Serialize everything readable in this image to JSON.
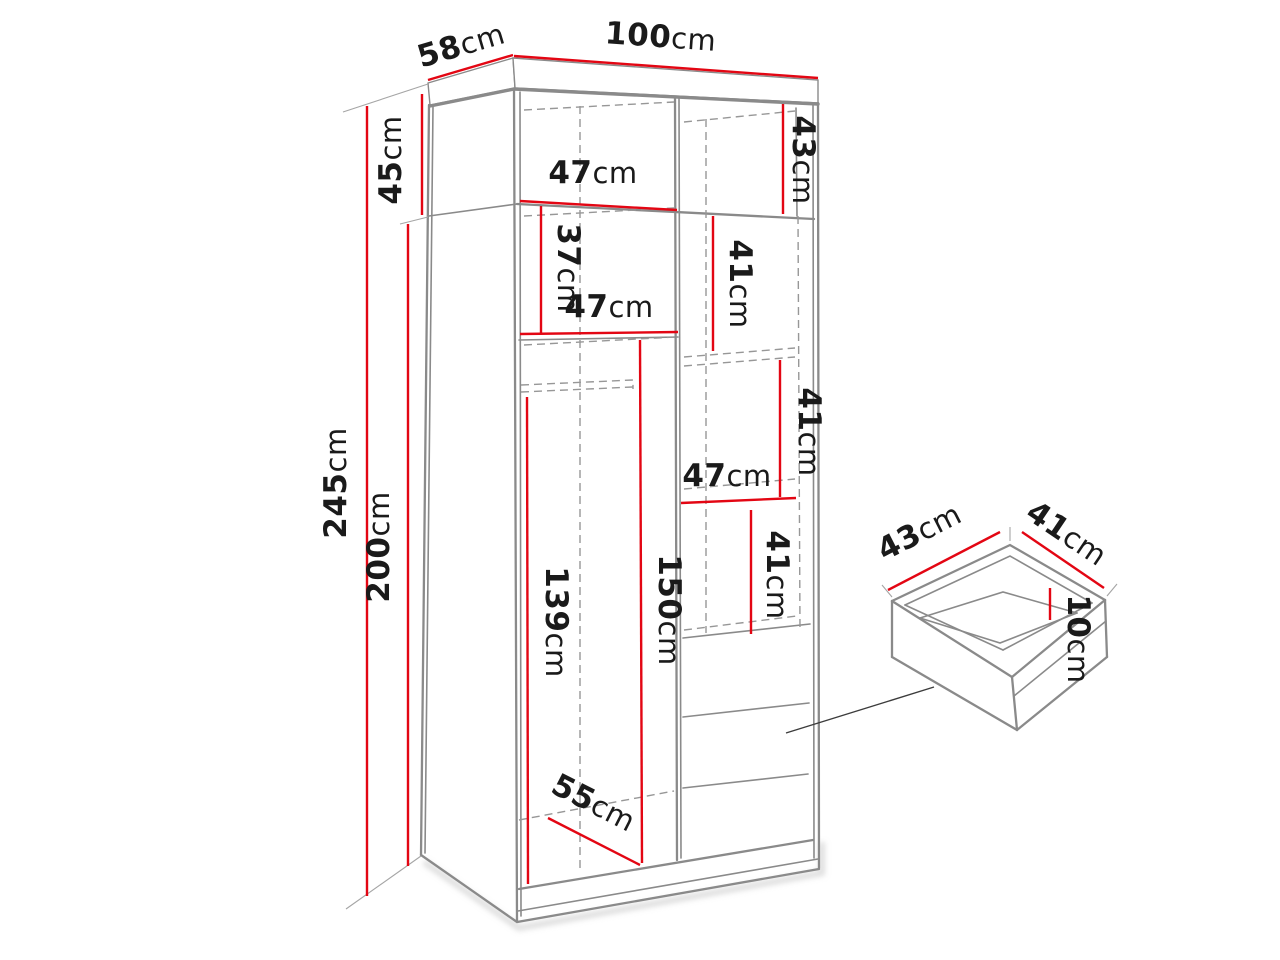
{
  "diagram_title": "wardrobe-dimension-diagram",
  "colors": {
    "dimension_line": "#e30613",
    "outline": "#8a8a8a",
    "dashed": "#979797",
    "text": "#1a1a1a",
    "background": "#ffffff"
  },
  "wardrobe": {
    "overall": {
      "width": {
        "value": "100",
        "unit": "cm"
      },
      "depth": {
        "value": "58",
        "unit": "cm"
      },
      "height": {
        "value": "245",
        "unit": "cm"
      }
    },
    "sections": {
      "top_section_height": {
        "value": "45",
        "unit": "cm"
      },
      "lower_section_height": {
        "value": "200",
        "unit": "cm"
      }
    },
    "interior": {
      "top_right_height": {
        "value": "43",
        "unit": "cm"
      },
      "top_shelf_width": {
        "value": "47",
        "unit": "cm"
      },
      "left_upper_height": {
        "value": "37",
        "unit": "cm"
      },
      "left_mid_shelf_width": {
        "value": "47",
        "unit": "cm"
      },
      "right_height_1": {
        "value": "41",
        "unit": "cm"
      },
      "right_height_2": {
        "value": "41",
        "unit": "cm"
      },
      "right_shelf_width": {
        "value": "47",
        "unit": "cm"
      },
      "right_height_3": {
        "value": "41",
        "unit": "cm"
      },
      "left_hanging_height": {
        "value": "139",
        "unit": "cm"
      },
      "right_column_height": {
        "value": "150",
        "unit": "cm"
      },
      "interior_depth": {
        "value": "55",
        "unit": "cm"
      }
    }
  },
  "drawer_detail": {
    "width": {
      "value": "43",
      "unit": "cm"
    },
    "depth": {
      "value": "41",
      "unit": "cm"
    },
    "height": {
      "value": "10",
      "unit": "cm"
    }
  }
}
